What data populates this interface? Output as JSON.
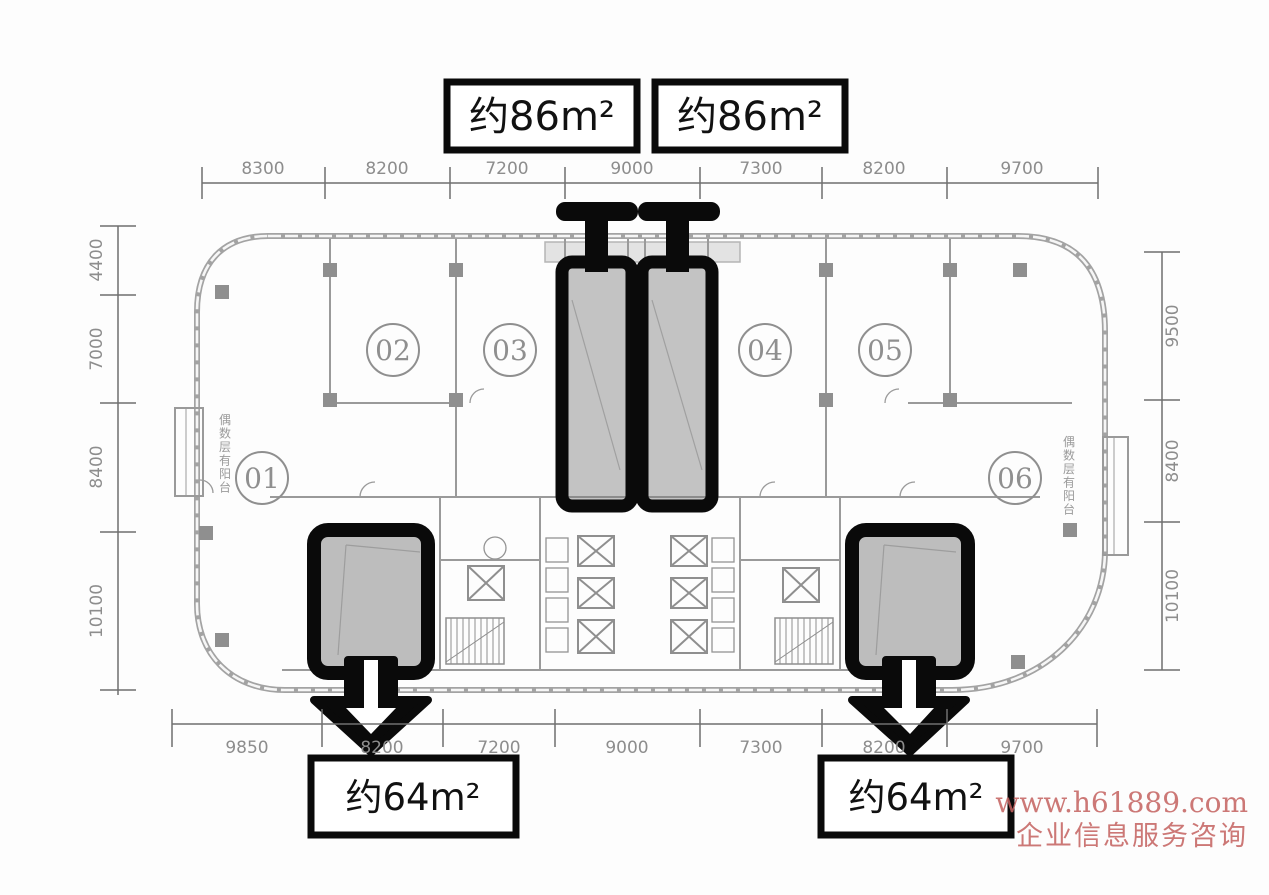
{
  "plan": {
    "area_labels": {
      "top_left": "约86m²",
      "top_right": "约86m²",
      "bottom_left": "约64m²",
      "bottom_right": "约64m²"
    },
    "units": [
      "01",
      "02",
      "03",
      "04",
      "05",
      "06"
    ],
    "balcony_note_left": "偶数层有阳台",
    "balcony_note_right": "偶数层有阳台",
    "dimensions": {
      "top": [
        "8300",
        "8200",
        "7200",
        "9000",
        "7300",
        "8200",
        "9700"
      ],
      "bottom": [
        "9850",
        "8200",
        "7200",
        "9000",
        "7300",
        "8200",
        "9700"
      ],
      "left": [
        "4400",
        "7000",
        "8400",
        "10100"
      ],
      "right": [
        "9500",
        "8400",
        "10100"
      ]
    },
    "colors": {
      "plan_line": "#9a9a9a",
      "dim_text": "#8d8d8d",
      "highlight_border": "#0a0a0a",
      "highlight_fill": "#b5b5b5",
      "watermark": "#c4615f"
    }
  },
  "watermark": {
    "line1": "www.h61889.com",
    "line2": "企业信息服务咨询"
  }
}
